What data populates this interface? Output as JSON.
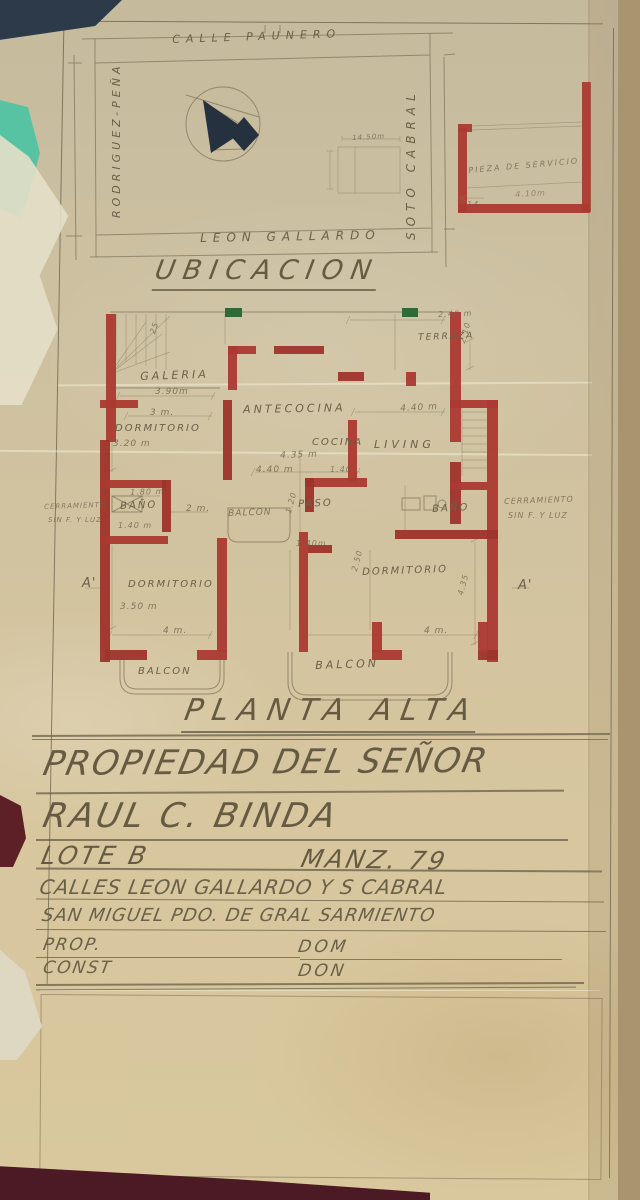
{
  "ubicacion": {
    "title": "UBICACION",
    "street_top": "CALLE PAUNERO",
    "street_left": "RODRIGUEZ-PEÑA",
    "street_right": "SOTO CABRAL",
    "street_bottom": "LEON GALLARDO",
    "lot_dim": "14.50m"
  },
  "service_room": {
    "label": "PIEZA DE SERVICIO",
    "dim": "4.10m",
    "corner_dim": "14"
  },
  "plan": {
    "title": "PLANTA ALTA",
    "stairs_count": "25",
    "rooms": {
      "galeria": "GALERIA",
      "dormitorio1": "DORMITORIO",
      "antecocina": "ANTECOCINA",
      "cocina": "COCINA",
      "living": "LIVING",
      "terraza": "TERRAZA",
      "bano1": "BAÑO",
      "bano2": "BAÑO",
      "paso": "PASO",
      "balcon_mid": "BALCON",
      "dormitorio2": "DORMITORIO",
      "dormitorio3": "DORMITORIO",
      "balcon1": "BALCON",
      "balcon2": "BALCON"
    },
    "dims": {
      "galeria_w": "3.90m",
      "dorm1_w": "3.20 m",
      "dorm1_d": "3 m.",
      "cocina_w": "4.35 m",
      "cocina_w2": "4.40 m",
      "cocina_d": "1.40",
      "living_w": "4.40 m",
      "terraza_w": "2.40 m",
      "terraza_d": "2.10",
      "bano1_w": "1.80 m",
      "bano1_d": "1.40 m",
      "bano1_r": "2 m.",
      "paso_w": "1.20",
      "dorm2_w": "3.50 m",
      "dorm2_b": "4 m.",
      "dorm3_l": "1.40m",
      "dorm3_w": "2.50",
      "dorm3_h": "4.35",
      "dorm3_b": "4 m."
    },
    "section_left": "A'",
    "section_right": "A'",
    "cerr1a": "CERRAMIENTO",
    "cerr1b": "SIN F. Y LUZ",
    "cerr2a": "CERRAMIENTO",
    "cerr2b": "SIN F. Y LUZ"
  },
  "title_block": {
    "owner_label": "PROPIEDAD DEL SEÑOR",
    "owner_name": "RAUL C. BINDA",
    "lote": "LOTE B",
    "manzana": "MANZ. 79",
    "calles": "CALLES LEON GALLARDO Y S CABRAL",
    "localidad": "SAN MIGUEL   PDO. DE GRAL SARMIENTO",
    "prop": "PROP.",
    "dom1": "DOM",
    "const": "CONST",
    "dom2": "DON"
  },
  "colors": {
    "wall_red": "#ab3a31",
    "paper": "#d2c3a0",
    "pencil": "#6b6048",
    "door_green": "#2f6b36",
    "compass_navy": "#25313f"
  }
}
